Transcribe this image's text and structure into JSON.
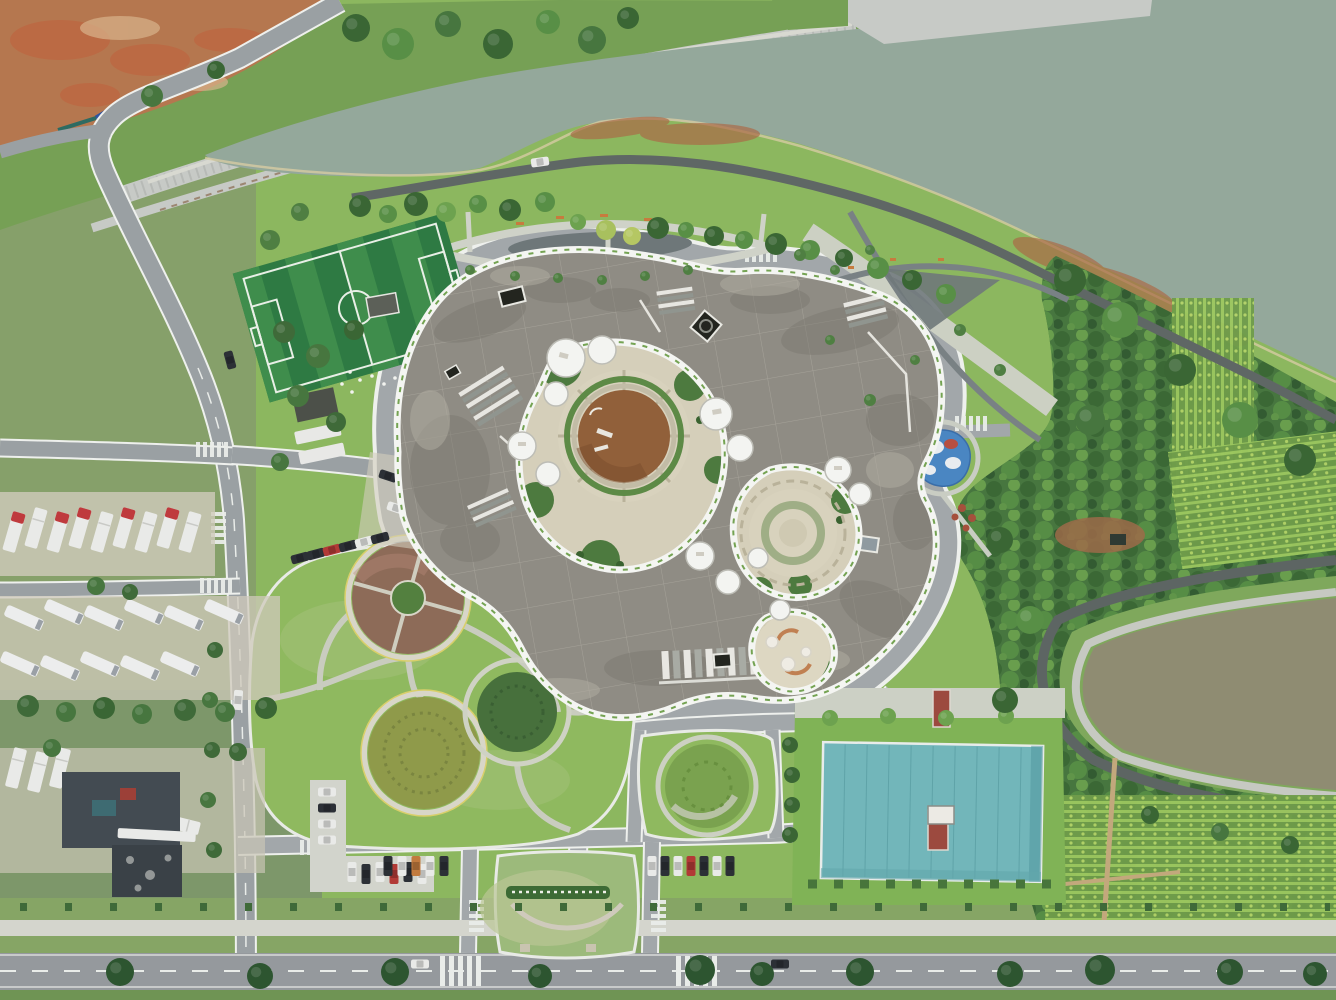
{
  "scene": {
    "type": "aerial-photo",
    "title": "Top-down drone view of a landscaped office campus beside a lake",
    "setting": "overcast daylight, nadir aerial perspective",
    "features": [
      "large grey-green lake",
      "stone riprap embankment terraces",
      "construction hoarding fence on red clay lot",
      "organic cloud-shaped office building with concrete roof",
      "white parapet edges",
      "rooftop skylight drums",
      "rooftop solar panel arrays",
      "central circular courtyard with drained brown pond",
      "paved inner courtyards",
      "perimeter ring road with white curbs",
      "artificial turf soccer pitch",
      "lawn with crossing curved paths",
      "ornamental circular flower beds (brown, olive, dark green)",
      "playground with blue rubber surface",
      "dense woodland and tree nursery rows",
      "fish pond with loop road",
      "teal-roofed sports hall",
      "truck and bus parking lots",
      "car parking rows",
      "entrance lawn island with hedge sign",
      "tree-lined boulevard"
    ],
    "palette": {
      "lawn": "#8cb75f",
      "lawn_dull": "#86a06a",
      "lawn_verge": "#86a565",
      "lawn_pale": "#a8c47f",
      "water": "#94a89b",
      "pond": "#8f8c72",
      "dirt": "#b5774f",
      "clay_red": "#c0623e",
      "road": "#a2a7aa",
      "road_main": "#95999d",
      "road_dark": "#5f6765",
      "path": "#cfd2c8",
      "pale_path": "#d4d5cd",
      "curb": "#eef0ed",
      "stone": "#c7cac6",
      "forest": "#47763f",
      "tree_dark": "#3a6634",
      "tree_mid": "#588f46",
      "tree_light": "#6da24f",
      "tree_yellow": "#a8c05e",
      "roof": "#8f8c84",
      "parapet": "#f4f5f2",
      "court_paving": "#d5cfba",
      "court_green": "#4d7a3f",
      "court_pond": "#91603a",
      "teal": "#72b6ba",
      "field": "#2e7a43",
      "field_stripe": "#3f8d4c",
      "line_white": "#e8efe6",
      "play_blue": "#4a86c2",
      "play_red": "#b74f41",
      "bed_brown": "#8d6b58",
      "bed_olive": "#8f9a4a",
      "bed_green": "#47703c",
      "fence_blue": "#2f54a0",
      "truck_red": "#bf3a3d",
      "veh_dark": "#2c3036",
      "veh_white": "#e9eae8",
      "bench": "#c77b3e",
      "hut_red": "#9c4a3f",
      "hedge": "#3d6b35"
    }
  }
}
